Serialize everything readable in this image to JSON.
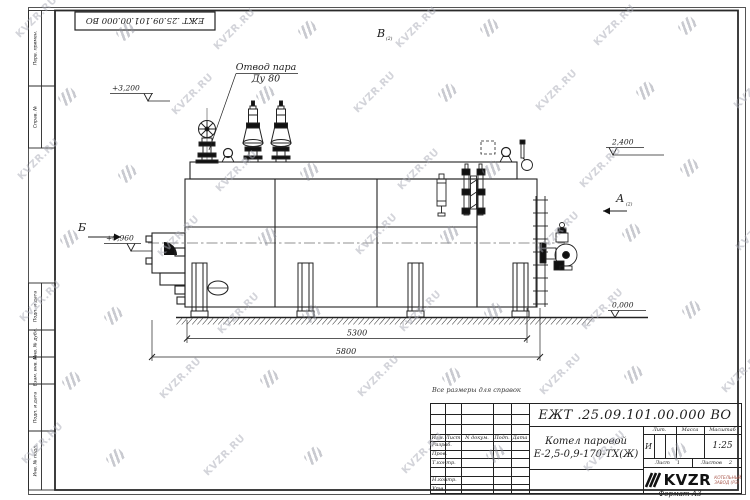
{
  "doc_number": "ЕЖТ .25.09.101.00.000  ВО",
  "watermark": {
    "text": "KVZR.RU"
  },
  "note": "Все размеры для справок",
  "format_label": "Формат А3",
  "margin_boxes": [
    "Перв. примен.",
    "Справ. №",
    "Подп. и дата",
    "Инв. № дубл.",
    "Взам. инв. №",
    "Подп. и дата",
    "Инв. № подл."
  ],
  "drawing": {
    "annotations": {
      "outlet1": "Отвод пара",
      "outlet2": "Ду 80",
      "elev_top": "+3,200",
      "elev_right": "2,400",
      "elev_front": "+0,960",
      "elev_zero": "0,000",
      "dim_inner": "5300",
      "dim_outer": "5800",
      "view_top": "В",
      "view_left": "Б",
      "view_right": "А",
      "sheet_ref": "(2)"
    }
  },
  "title_block": {
    "name_line1": "Котел паровой",
    "name_line2": "Е-2,5-0,9-170-ТХ(Ж)",
    "col_izm": "Изм.",
    "col_list": "Лист",
    "col_ndokum": "N докум.",
    "col_podp": "Подп.",
    "col_data": "Дата",
    "rows": [
      "Разраб.",
      "Пров.",
      "Т.контр.",
      "",
      "Н.контр.",
      "Утв."
    ],
    "lit_header": "Лит.",
    "lit_value": "И",
    "massa_header": "Масса",
    "masshtab_header": "Масштаб",
    "masshtab_value": "1:25",
    "list_label": "Лист",
    "list_value": "1",
    "listov_label": "Листов",
    "listov_value": "2",
    "logo_text": "KVZR",
    "logo_sub1": "КОТЕЛЬНЫЙ",
    "logo_sub2": "ЗАВОД (РЭ)"
  }
}
